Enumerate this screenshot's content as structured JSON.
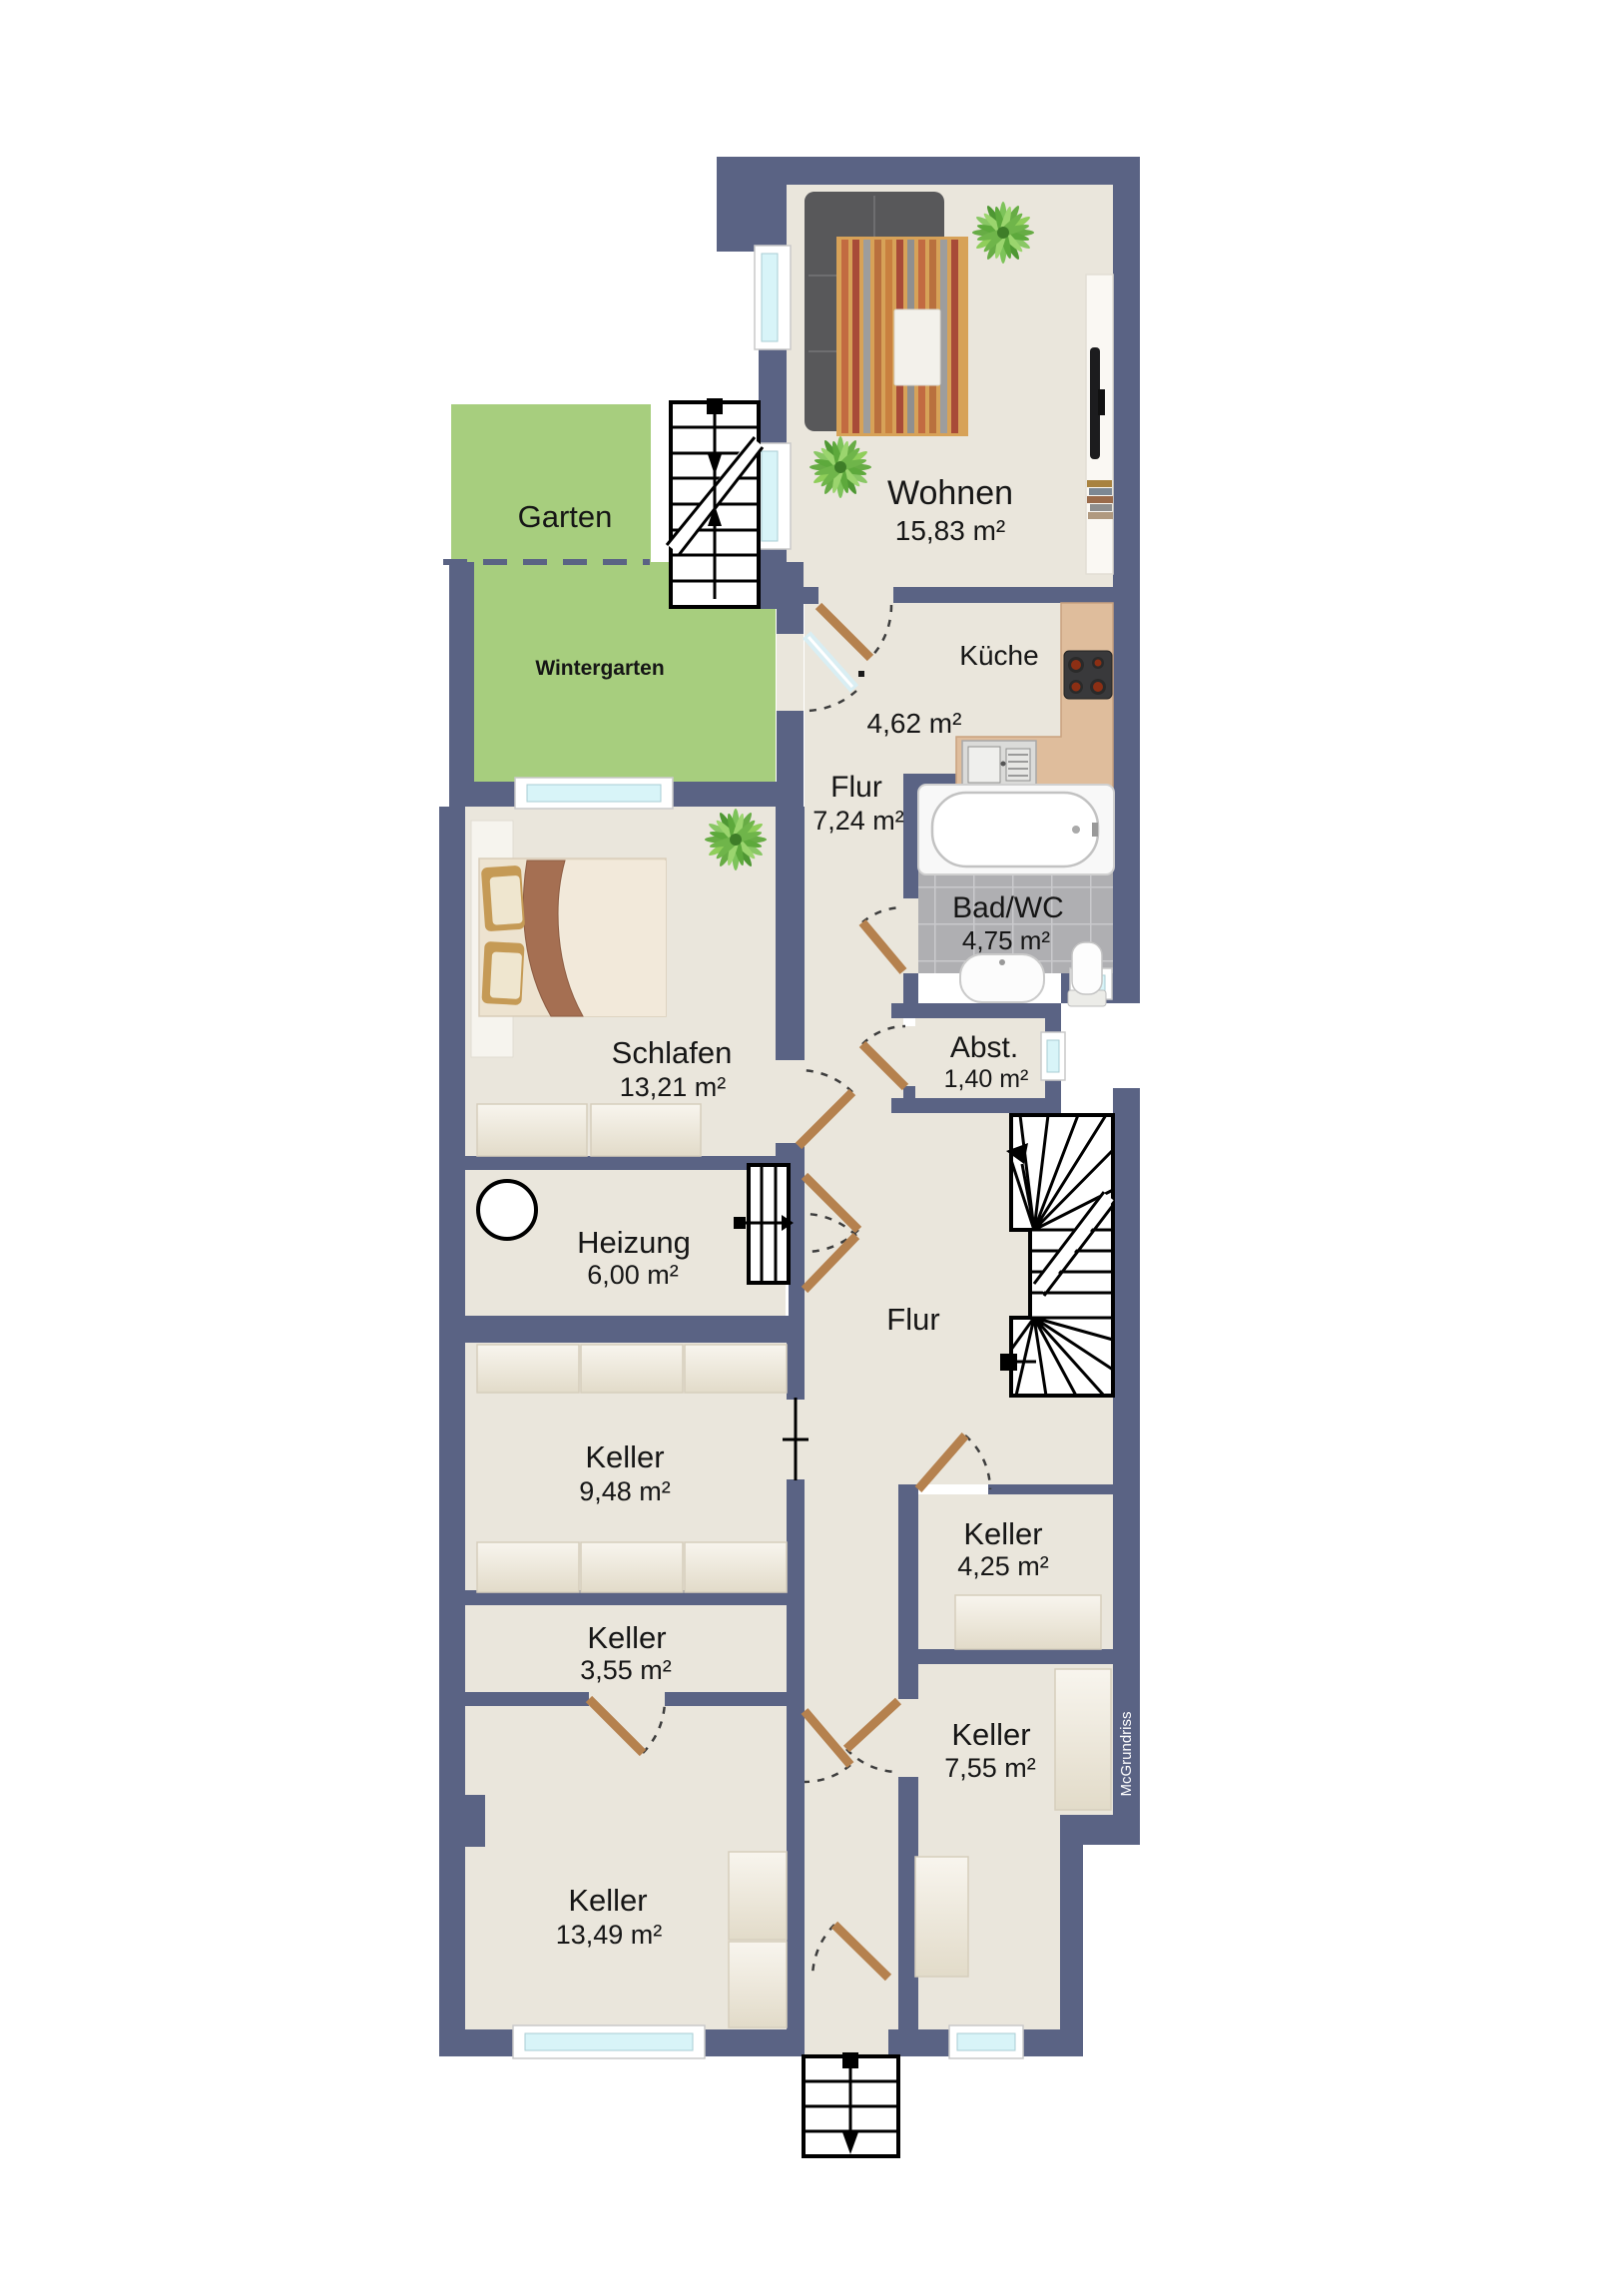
{
  "rooms": {
    "wohnen": {
      "name": "Wohnen",
      "area": "15,83 m²"
    },
    "kueche": {
      "name": "Küche",
      "area": "4,62 m²"
    },
    "flur": {
      "name": "Flur",
      "area": "7,24 m²"
    },
    "bad": {
      "name": "Bad/WC",
      "area": "4,75 m²"
    },
    "abstellraum": {
      "name": "Abst.",
      "area": "1,40 m²"
    },
    "schlafen": {
      "name": "Schlafen",
      "area": "13,21 m²"
    },
    "heizung": {
      "name": "Heizung",
      "area": "6,00 m²"
    },
    "flur_keller": {
      "name": "Flur",
      "area": ""
    },
    "keller_948": {
      "name": "Keller",
      "area": "9,48 m²"
    },
    "keller_425": {
      "name": "Keller",
      "area": "4,25 m²"
    },
    "keller_355": {
      "name": "Keller",
      "area": "3,55 m²"
    },
    "keller_755": {
      "name": "Keller",
      "area": "7,55 m²"
    },
    "keller_1349": {
      "name": "Keller",
      "area": "13,49 m²"
    }
  },
  "outdoor": {
    "garten": {
      "name": "Garten"
    },
    "wintergarten": {
      "name": "Wintergarten"
    }
  },
  "watermark": {
    "text": "McGrundriss"
  },
  "colors": {
    "wall": "#5a6384",
    "floor": "#eae6dc",
    "garden": "#a7ce7e",
    "window_glass": "#d8f4f8",
    "door_wood": "#b5814e",
    "kitchen_counter": "#dfbd9c",
    "bath_tile": "#afafb2"
  }
}
